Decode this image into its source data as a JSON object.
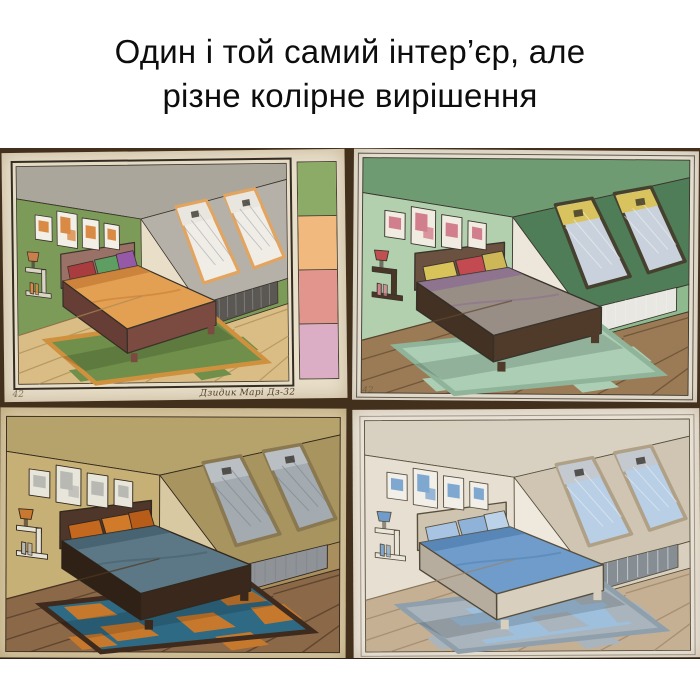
{
  "header": {
    "line1": "Один і той самий інтер’єр, але",
    "line2": "різне колірне вирішення"
  },
  "collage": {
    "background_color": "#42301c",
    "paintings": [
      {
        "id": "green-orange-scheme",
        "corner_mark": "42",
        "signature": "Дзидик Марі Дз-32",
        "swatches": [
          "#8cab67",
          "#f2b97e",
          "#e2958d",
          "#dcaec6"
        ],
        "colors": {
          "paper": "#e9dfc9",
          "ink": "#3a332a",
          "wall": "#7d9b58",
          "slopeTop": "#aaa69c",
          "slope": "#b5b1a8",
          "knee": "#7d9b58",
          "glass": "#efede6",
          "blind": "#e9e6df",
          "winframe": "#e2a45f",
          "hatch": "#9aa0a8",
          "floor": "#d9bd85",
          "plank": "#a98a55",
          "rug": "#6f8f4a",
          "rugInner": "#6f8f4a",
          "rugB": "#6f8f4a",
          "rugBorder": "#d0913f",
          "bed": "#e39f52",
          "fold": "#c87f38",
          "frame": "#7b4a40",
          "headboard": "#9a7166",
          "pillow1": "#a83c3e",
          "pillow2": "#5f9e62",
          "pillow3": "#9659a8",
          "art": "#d98a45",
          "artbg": "#f2efe6",
          "radiator": "#5b5752",
          "shelf": "#d8d4c6",
          "lamp": "#c87f4a"
        }
      },
      {
        "id": "mint-mauve-scheme",
        "corner_mark": "42",
        "signature": "",
        "swatches": [],
        "colors": {
          "paper": "#ece7da",
          "ink": "#3a352c",
          "wall": "#b2d0ae",
          "slopeTop": "#6f9b72",
          "slope": "#4e7d58",
          "knee": "#8fb98f",
          "glass": "#c9d2dc",
          "blind": "#d9c35e",
          "winframe": "#46412f",
          "hatch": "#eef1f2",
          "floor": "#9b7b56",
          "plank": "#634830",
          "rug": "#abceb4",
          "rugInner": "#abceb4",
          "rugB": "#abceb4",
          "rugBorder": "#8fb49a",
          "bed": "#988e86",
          "fold": "#8d7090",
          "frame": "#503b2b",
          "headboard": "#6a5140",
          "pillow1": "#d8c25a",
          "pillow2": "#c24a50",
          "pillow3": "#cdb757",
          "art": "#d27f8d",
          "artbg": "#f0ece2",
          "radiator": "#e8e7e1",
          "shelf": "#4a3628",
          "lamp": "#c05050"
        }
      },
      {
        "id": "ochre-teal-scheme",
        "corner_mark": "",
        "signature": "",
        "swatches": [],
        "colors": {
          "paper": "#d9c9a2",
          "ink": "#33281c",
          "wall": "#c7b076",
          "slopeTop": "#b5a36b",
          "slope": "#a8945e",
          "knee": "#a98f5e",
          "glass": "#a4abb0",
          "blind": "#b9bfc3",
          "winframe": "#8a7850",
          "hatch": "#7c848a",
          "floor": "#8a6848",
          "plank": "#4e3824",
          "rug": "#2f6a84",
          "rugInner": "#2f6a84",
          "rugB": "#c6792c",
          "rugBorder": "#3f2a1e",
          "bed": "#5c7886",
          "fold": "#44606e",
          "frame": "#3a281c",
          "headboard": "#4e362a",
          "pillow1": "#c4681f",
          "pillow2": "#d07a2a",
          "pillow3": "#b85c1a",
          "art": "#b9b9b4",
          "artbg": "#e8e5da",
          "radiator": "#8f9296",
          "shelf": "#e5e2d6",
          "lamp": "#c87830"
        }
      },
      {
        "id": "white-blue-scheme",
        "corner_mark": "",
        "signature": "",
        "swatches": [],
        "colors": {
          "paper": "#efe9dd",
          "ink": "#58503f",
          "wall": "#e7e0d2",
          "slopeTop": "#d8d0c0",
          "slope": "#cfc5b2",
          "knee": "#d8cfbf",
          "glass": "#b8cfe6",
          "blind": "#c3c9cf",
          "winframe": "#b0a086",
          "hatch": "#e9eef4",
          "floor": "#c6b094",
          "plank": "#9a8368",
          "rug": "#a9b4bc",
          "rugInner": "#9fc0dc",
          "rugB": "#a9b4bc",
          "rugBorder": "#8fa0ac",
          "bed": "#6f9cca",
          "fold": "#5584b4",
          "frame": "#d9cfbe",
          "headboard": "#cfc4b0",
          "pillow1": "#a9c4e2",
          "pillow2": "#8fb2d8",
          "pillow3": "#bcd2e8",
          "art": "#7fa8d0",
          "artbg": "#f2efe8",
          "radiator": "#868e94",
          "shelf": "#e9e5da",
          "lamp": "#6f9cca"
        }
      }
    ]
  }
}
